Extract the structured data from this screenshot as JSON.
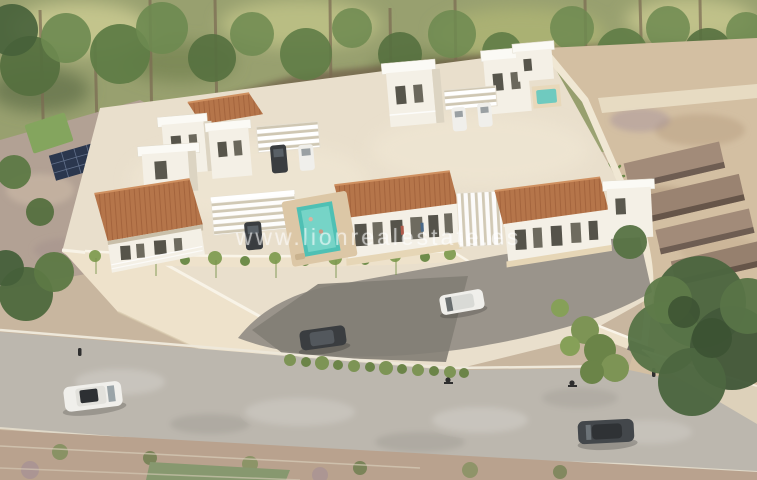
{
  "image": {
    "type": "aerial-3d-architectural-render",
    "subject": "New-build residential villa development: white modern villas with terracotta pitched roofs, flat white roofs, pergola carports, a small pool, a cream perimeter retaining wall with cascading plants, internal access road and public road with cars, surrounded by trees, a neighbouring parcel with pond and solar panels, and sandy terraced ground",
    "watermark": "www.lionrealestate.es"
  },
  "watermark": {
    "text": "www.lionrealestate.es",
    "color": "#ffffff"
  },
  "palette": {
    "background_foliage": "#98a06f",
    "tree_green": "#5f7c46",
    "tree_dark": "#43593a",
    "terrain_scrub": "#b2a194",
    "sand": "#d3bfa2",
    "platform": "#e9dfcc",
    "wall": "#eee2cb",
    "villa_white": "#f4f0e6",
    "villa_shadow": "#dcd4c2",
    "roof_terracotta": "#b5754a",
    "pool_turquoise": "#4fc0b4",
    "hedge_green": "#86a058",
    "road_asphalt": "#9a948b",
    "road_light": "#bcb7ae",
    "car_dark": "#3a3d40",
    "car_white": "#f0efeb",
    "solar_panel": "#2b374e",
    "pond_blue": "#6b93a8",
    "lawn_green": "#84a55e"
  },
  "scene": {
    "areas": [
      "tree-lined-background",
      "neighbor-parcel-pond-solar-panels",
      "villa-development-platform",
      "perimeter-wall-cascading-plants",
      "internal-access-road",
      "public-road",
      "sandy-terraced-lot",
      "large-tree-bottom-right"
    ],
    "vehicles": [
      "white-car-internal-road",
      "dark-car-internal-road",
      "white-van-public-road",
      "dark-sedan-public-road",
      "parked-dark-cars",
      "parked-white-cars"
    ],
    "buildings": {
      "style": "modern-white-villas",
      "features": [
        "flat-white-roof-slabs",
        "terracotta-pitched-roofs",
        "white-pergolas",
        "balconies",
        "small-pools"
      ]
    }
  }
}
